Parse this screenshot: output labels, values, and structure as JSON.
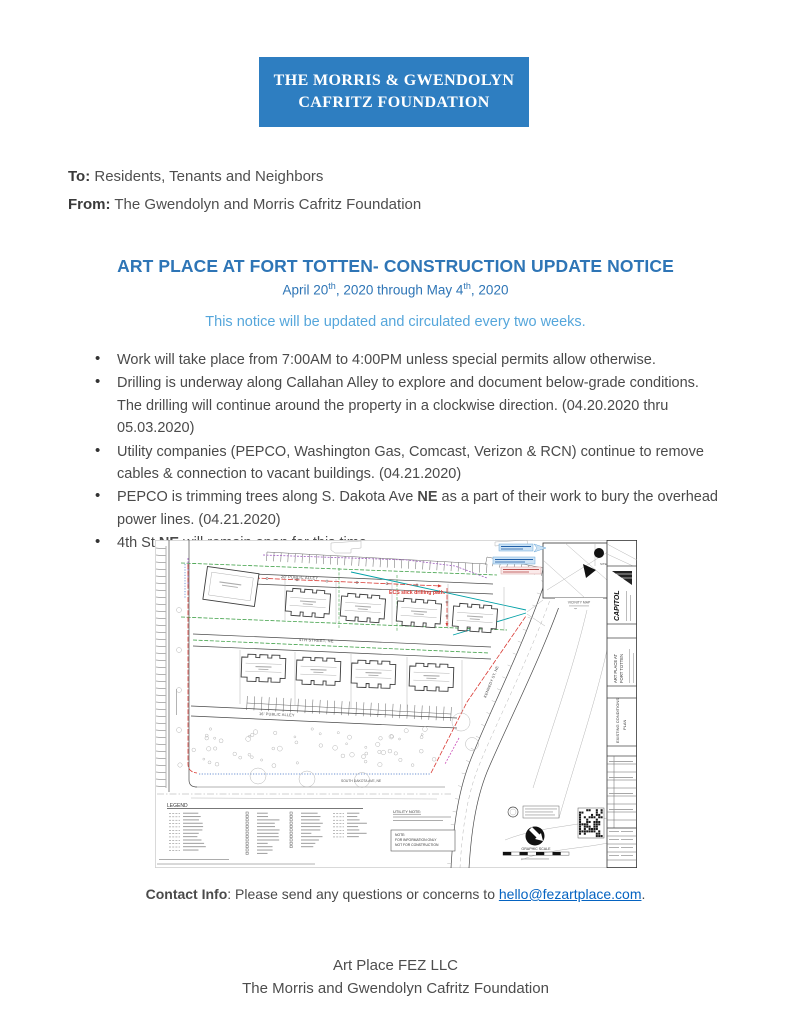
{
  "document": {
    "banner": {
      "line1": "THE MORRIS & GWENDOLYN",
      "line2": "CAFRITZ FOUNDATION"
    },
    "to_label": "To:",
    "to_value": " Residents, Tenants and Neighbors",
    "from_label": "From:",
    "from_value": " The Gwendolyn and Morris Cafritz Foundation",
    "title": "ART PLACE AT FORT TOTTEN- CONSTRUCTION UPDATE NOTICE",
    "date_line": [
      {
        "t": "April 20"
      },
      {
        "t": "th",
        "sup": true
      },
      {
        "t": ", 2020 through May 4"
      },
      {
        "t": "th",
        "sup": true
      },
      {
        "t": ", 2020"
      }
    ],
    "update_note": "This notice will be updated and circulated every two weeks.",
    "bullets": [
      [
        {
          "t": "Work will take place from 7:00AM to 4:00PM unless special permits allow otherwise."
        }
      ],
      [
        {
          "t": "Drilling is underway along Callahan Alley to explore and document below-grade conditions. The drilling will continue around the property in a clockwise direction. (04.20.2020 thru 05.03.2020)"
        }
      ],
      [
        {
          "t": "Utility companies (PEPCO, Washington Gas, Comcast, Verizon & RCN) continue to remove cables & connection to vacant buildings. (04.21.2020)"
        }
      ],
      [
        {
          "t": "PEPCO is trimming trees along S. Dakota Ave "
        },
        {
          "t": "NE",
          "b": true
        },
        {
          "t": " as a part of their work to bury the overhead power lines. (04.21.2020)"
        }
      ],
      [
        {
          "t": "4th St "
        },
        {
          "t": "NE",
          "b": true
        },
        {
          "t": " will remain open for this time."
        }
      ]
    ],
    "contact": [
      {
        "t": "Contact Info",
        "b": true
      },
      {
        "t": ": Please send any questions or concerns to "
      },
      {
        "t": "hello@fezartplace.com",
        "link": true
      },
      {
        "t": "."
      }
    ],
    "footer_line1": "Art Place FEZ LLC",
    "footer_line2": "The Morris and Gwendolyn Cafritz Foundation"
  },
  "site_plan": {
    "labels": {
      "alley_top": "20' PUBLIC ALLEY",
      "street_mid": "4TH STREET, NE",
      "alley_bottom": "16' PUBLIC ALLEY",
      "ave_bottom": "SOUTH DAKOTA AVE, NE",
      "street_right": "KENNEDY ST, NE",
      "drill_path": "ECS slick drilling path.",
      "legend_title": "LEGEND",
      "utility_note": "UTILITY NOTE:",
      "note_line1": "NOTE:",
      "note_line2": "FOR INFORMATION ONLY",
      "note_line3": "NOT FOR CONSTRUCTION",
      "vicinity_caption": "VICINITY MAP",
      "site_marker": "SITE",
      "graphic_scale": "GRAPHIC SCALE",
      "firm_name": "CAPITOL",
      "project_line1": "ART PLACE AT",
      "project_line2": "FORT TOTTEN",
      "sheet_line1": "EXISTING CONDITIONS",
      "sheet_line2": "PLAN"
    },
    "line_colors": {
      "boundary_red": "#d93a34",
      "survey_green": "#3fa047",
      "water_teal": "#00a0a6",
      "electric_purple": "#a05fc0",
      "comm_blue": "#3e6fc4",
      "gas_magenta": "#cc4fb8"
    }
  },
  "colors": {
    "banner_bg": "#2e7ec1",
    "banner_fg": "#ffffff",
    "title_blue": "#2e75b6",
    "note_blue": "#55a6db",
    "link_blue": "#0563c1",
    "body_text": "#4a4a4a"
  }
}
